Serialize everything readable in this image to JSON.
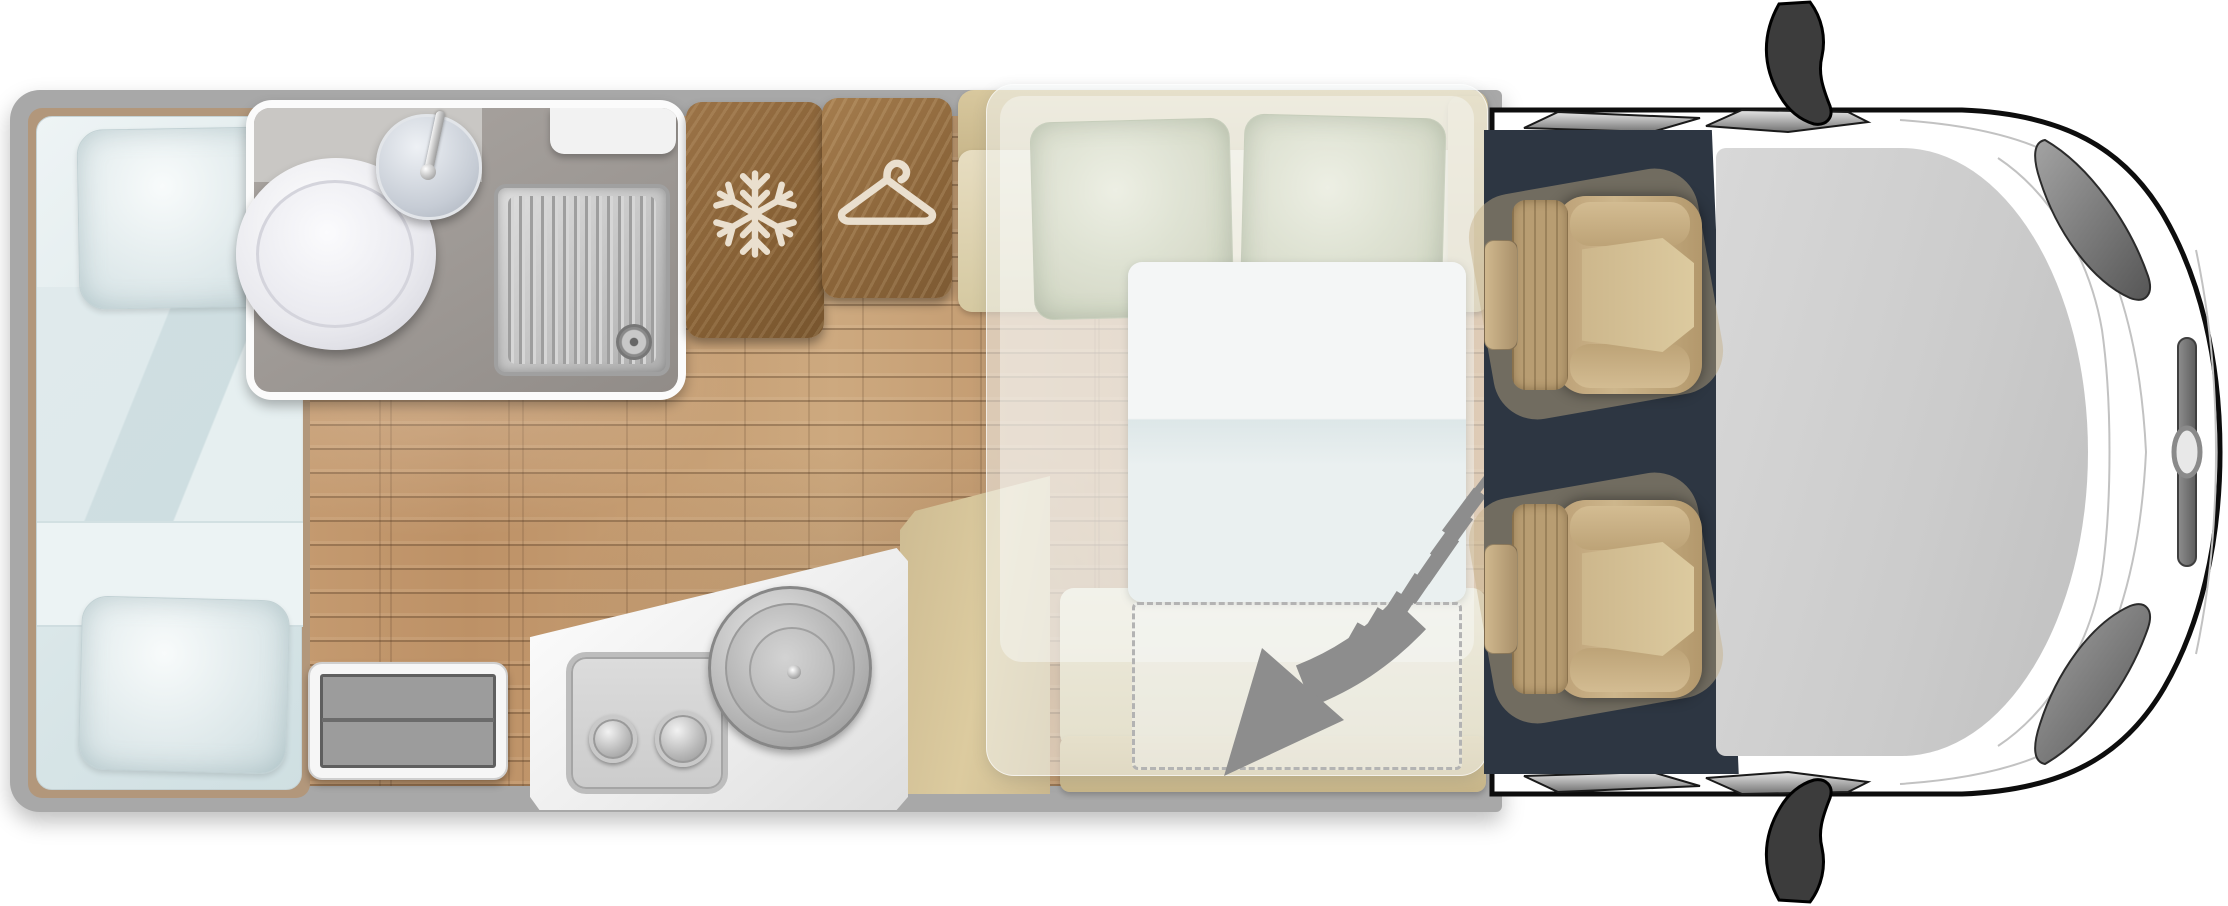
{
  "diagram": {
    "type": "motorhome-floorplan",
    "view": "top-down",
    "vehicle": "coachbuilt camper van",
    "areas": [
      {
        "name": "rear-bed",
        "items": [
          "mattress",
          "pillow",
          "pillow",
          "folded-duvet"
        ]
      },
      {
        "name": "bathroom",
        "items": [
          "toilet",
          "washbasin",
          "faucet",
          "shower-tray",
          "drain",
          "shelf",
          "counter"
        ]
      },
      {
        "name": "fridge-cabinet",
        "icon": "snowflake-icon"
      },
      {
        "name": "wardrobe-cabinet",
        "icon": "hanger-icon"
      },
      {
        "name": "dinette-sofa",
        "items": [
          "backrest",
          "seat-cushion",
          "armrest",
          "pillow",
          "pillow"
        ]
      },
      {
        "name": "drop-down-bed",
        "items": [
          "mattress-overlay",
          "sheet-panel",
          "dashed-footprint"
        ],
        "icon": "drop-down-arrow-icon"
      },
      {
        "name": "kitchen",
        "items": [
          "two-burner-hob",
          "burner-knob",
          "burner-knob",
          "round-sink"
        ]
      },
      {
        "name": "entry-step"
      },
      {
        "name": "side-bench"
      },
      {
        "name": "rear-facing-bench"
      },
      {
        "name": "cab",
        "items": [
          "driver-seat",
          "passenger-seat",
          "cab-floor",
          "windshield",
          "wiper",
          "wiper",
          "wiper",
          "wiper",
          "mirror",
          "mirror",
          "headlight",
          "headlight",
          "grille-bar",
          "front-emblem",
          "hood-contours"
        ]
      }
    ],
    "icons": [
      "snowflake-icon",
      "hanger-icon",
      "drop-down-arrow-icon"
    ]
  },
  "colors": {
    "wall": "#a8a8a8",
    "trim": "#b2977b",
    "floor": "#c49a6e",
    "counter": "#c9c7c4",
    "bathFloor": "#a19c98",
    "cabinetWood": "#8a6239",
    "cabinetIcon": "#eadfce",
    "bench": "#d6caa4",
    "benchDark": "#c8b68b",
    "bedBlue": "#e6eff0",
    "pillowGreen": "#dfe2d4",
    "overlay": "rgba(243,247,247,0.5)",
    "arrow": "#8d8d8d",
    "cab": "#2d3642",
    "seat": "#c5ad83",
    "glass": "#cfcfcf",
    "bodyOutline": "#0d0d0d",
    "bodyFill": "#ffffff"
  }
}
